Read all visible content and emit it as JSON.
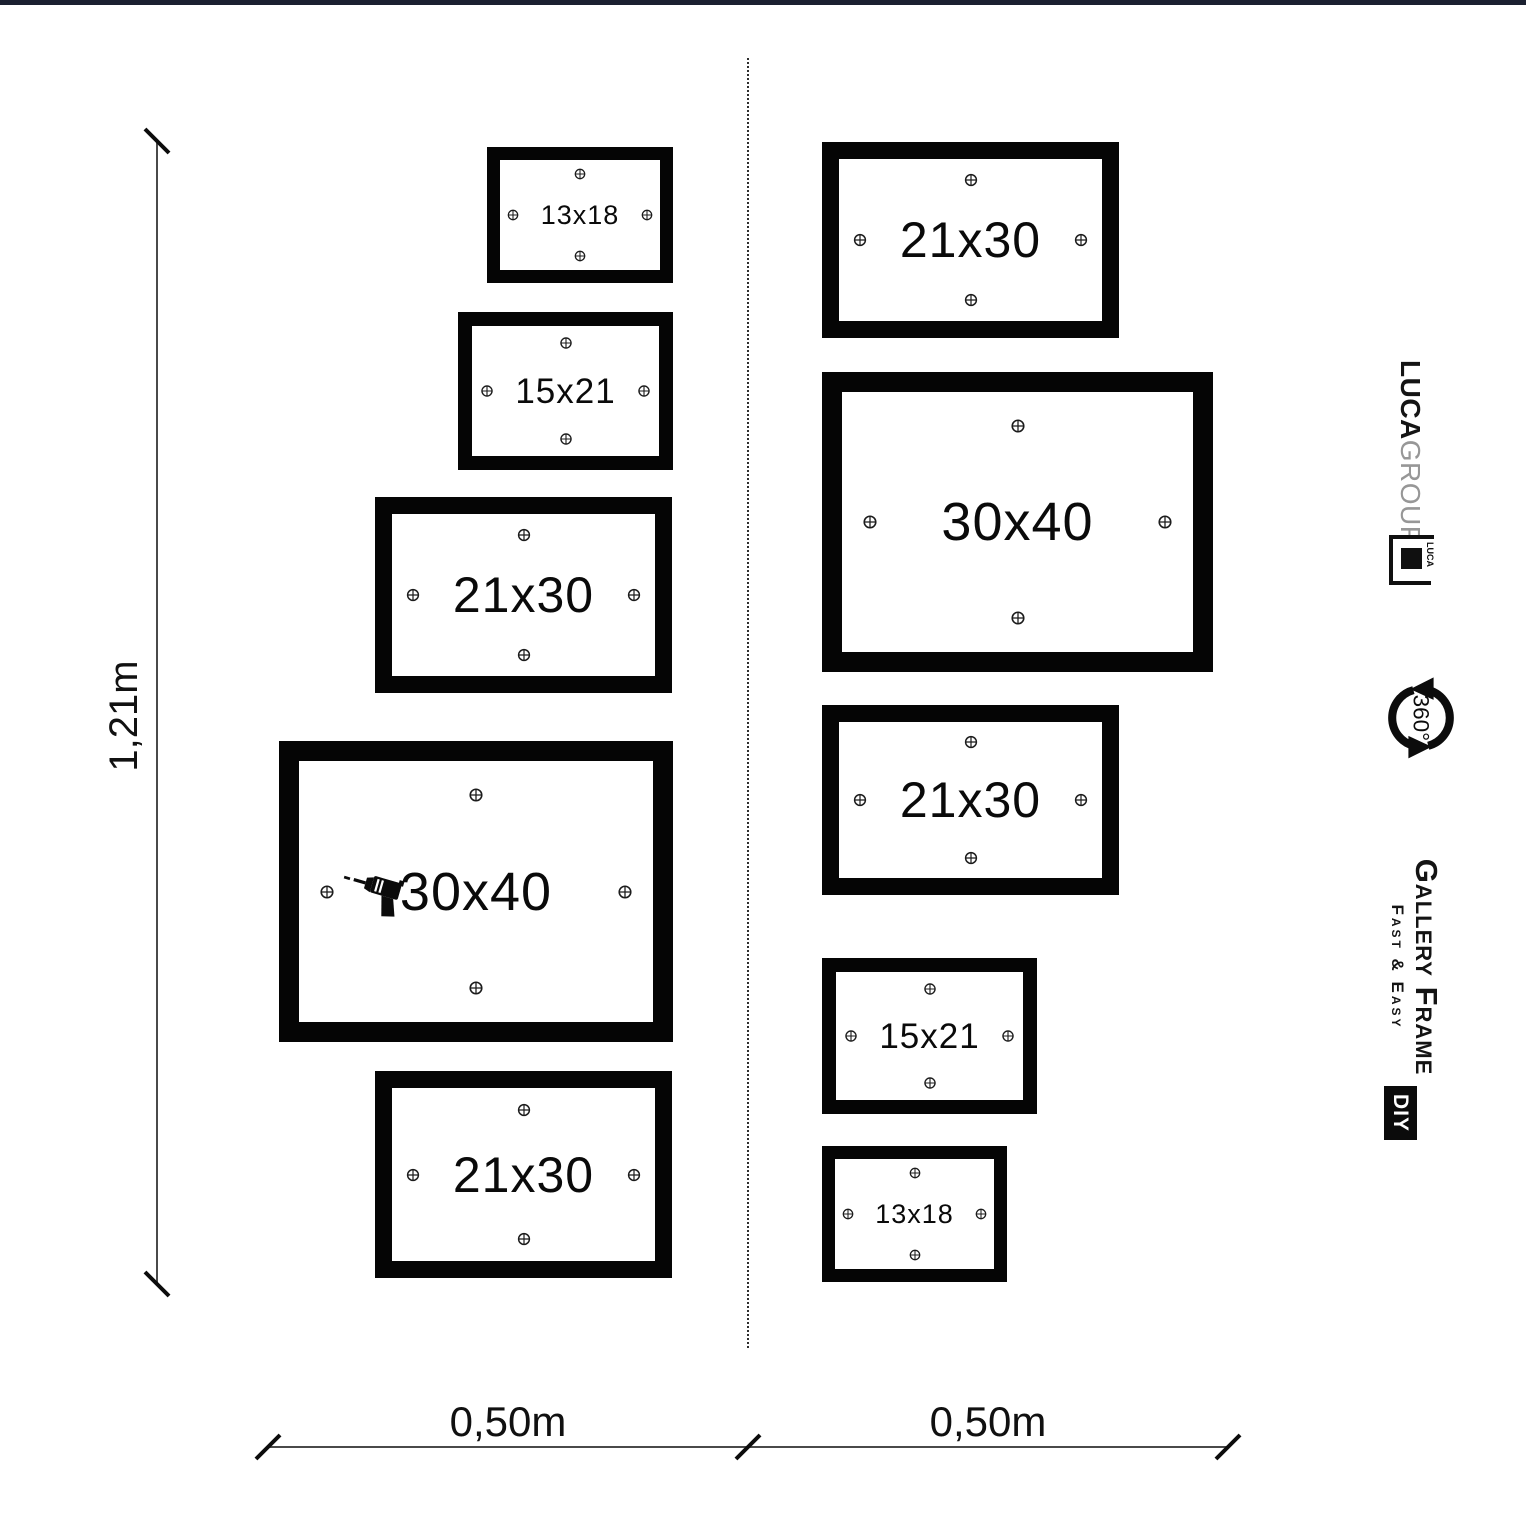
{
  "page": {
    "top_bar_color": "#1b2030",
    "background": "#ffffff"
  },
  "dimensions": {
    "height_label": "1,21m",
    "width_left_label": "0,50m",
    "width_right_label": "0,50m"
  },
  "frames": [
    {
      "id": "left-13x18",
      "label": "13x18",
      "x": 487,
      "y": 147,
      "w": 186,
      "h": 136,
      "border": 13,
      "font_px": 27,
      "screw_px": 13,
      "drill": false
    },
    {
      "id": "left-15x21",
      "label": "15x21",
      "x": 458,
      "y": 312,
      "w": 215,
      "h": 158,
      "border": 14,
      "font_px": 35,
      "screw_px": 14,
      "drill": false
    },
    {
      "id": "left-21x30-top",
      "label": "21x30",
      "x": 375,
      "y": 497,
      "w": 297,
      "h": 196,
      "border": 17,
      "font_px": 50,
      "screw_px": 15,
      "drill": false
    },
    {
      "id": "left-30x40",
      "label": "30x40",
      "x": 279,
      "y": 741,
      "w": 394,
      "h": 301,
      "border": 20,
      "font_px": 54,
      "screw_px": 16,
      "drill": true
    },
    {
      "id": "left-21x30-bottom",
      "label": "21x30",
      "x": 375,
      "y": 1071,
      "w": 297,
      "h": 207,
      "border": 17,
      "font_px": 50,
      "screw_px": 15,
      "drill": false
    },
    {
      "id": "right-21x30-top",
      "label": "21x30",
      "x": 822,
      "y": 142,
      "w": 297,
      "h": 196,
      "border": 17,
      "font_px": 50,
      "screw_px": 15,
      "drill": false
    },
    {
      "id": "right-30x40",
      "label": "30x40",
      "x": 822,
      "y": 372,
      "w": 391,
      "h": 300,
      "border": 20,
      "font_px": 54,
      "screw_px": 16,
      "drill": false
    },
    {
      "id": "right-21x30-mid",
      "label": "21x30",
      "x": 822,
      "y": 705,
      "w": 297,
      "h": 190,
      "border": 17,
      "font_px": 50,
      "screw_px": 15,
      "drill": false
    },
    {
      "id": "right-15x21",
      "label": "15x21",
      "x": 822,
      "y": 958,
      "w": 215,
      "h": 156,
      "border": 14,
      "font_px": 35,
      "screw_px": 14,
      "drill": false
    },
    {
      "id": "right-13x18",
      "label": "13x18",
      "x": 822,
      "y": 1146,
      "w": 185,
      "h": 136,
      "border": 13,
      "font_px": 27,
      "screw_px": 13,
      "drill": false
    }
  ],
  "branding": {
    "luca_group": {
      "bold": "LUCA",
      "light": "GROUP"
    },
    "logo_text": "LUCA",
    "rotation_icon_label": "360°",
    "gallery_frame": {
      "title": "Gallery Frame",
      "subtitle": "Fast & Easy"
    },
    "diy_label": "DIY"
  },
  "icons": {
    "screw": "screw-head-icon",
    "drill": "drill-icon",
    "rotation": "rotation-360-icon"
  }
}
